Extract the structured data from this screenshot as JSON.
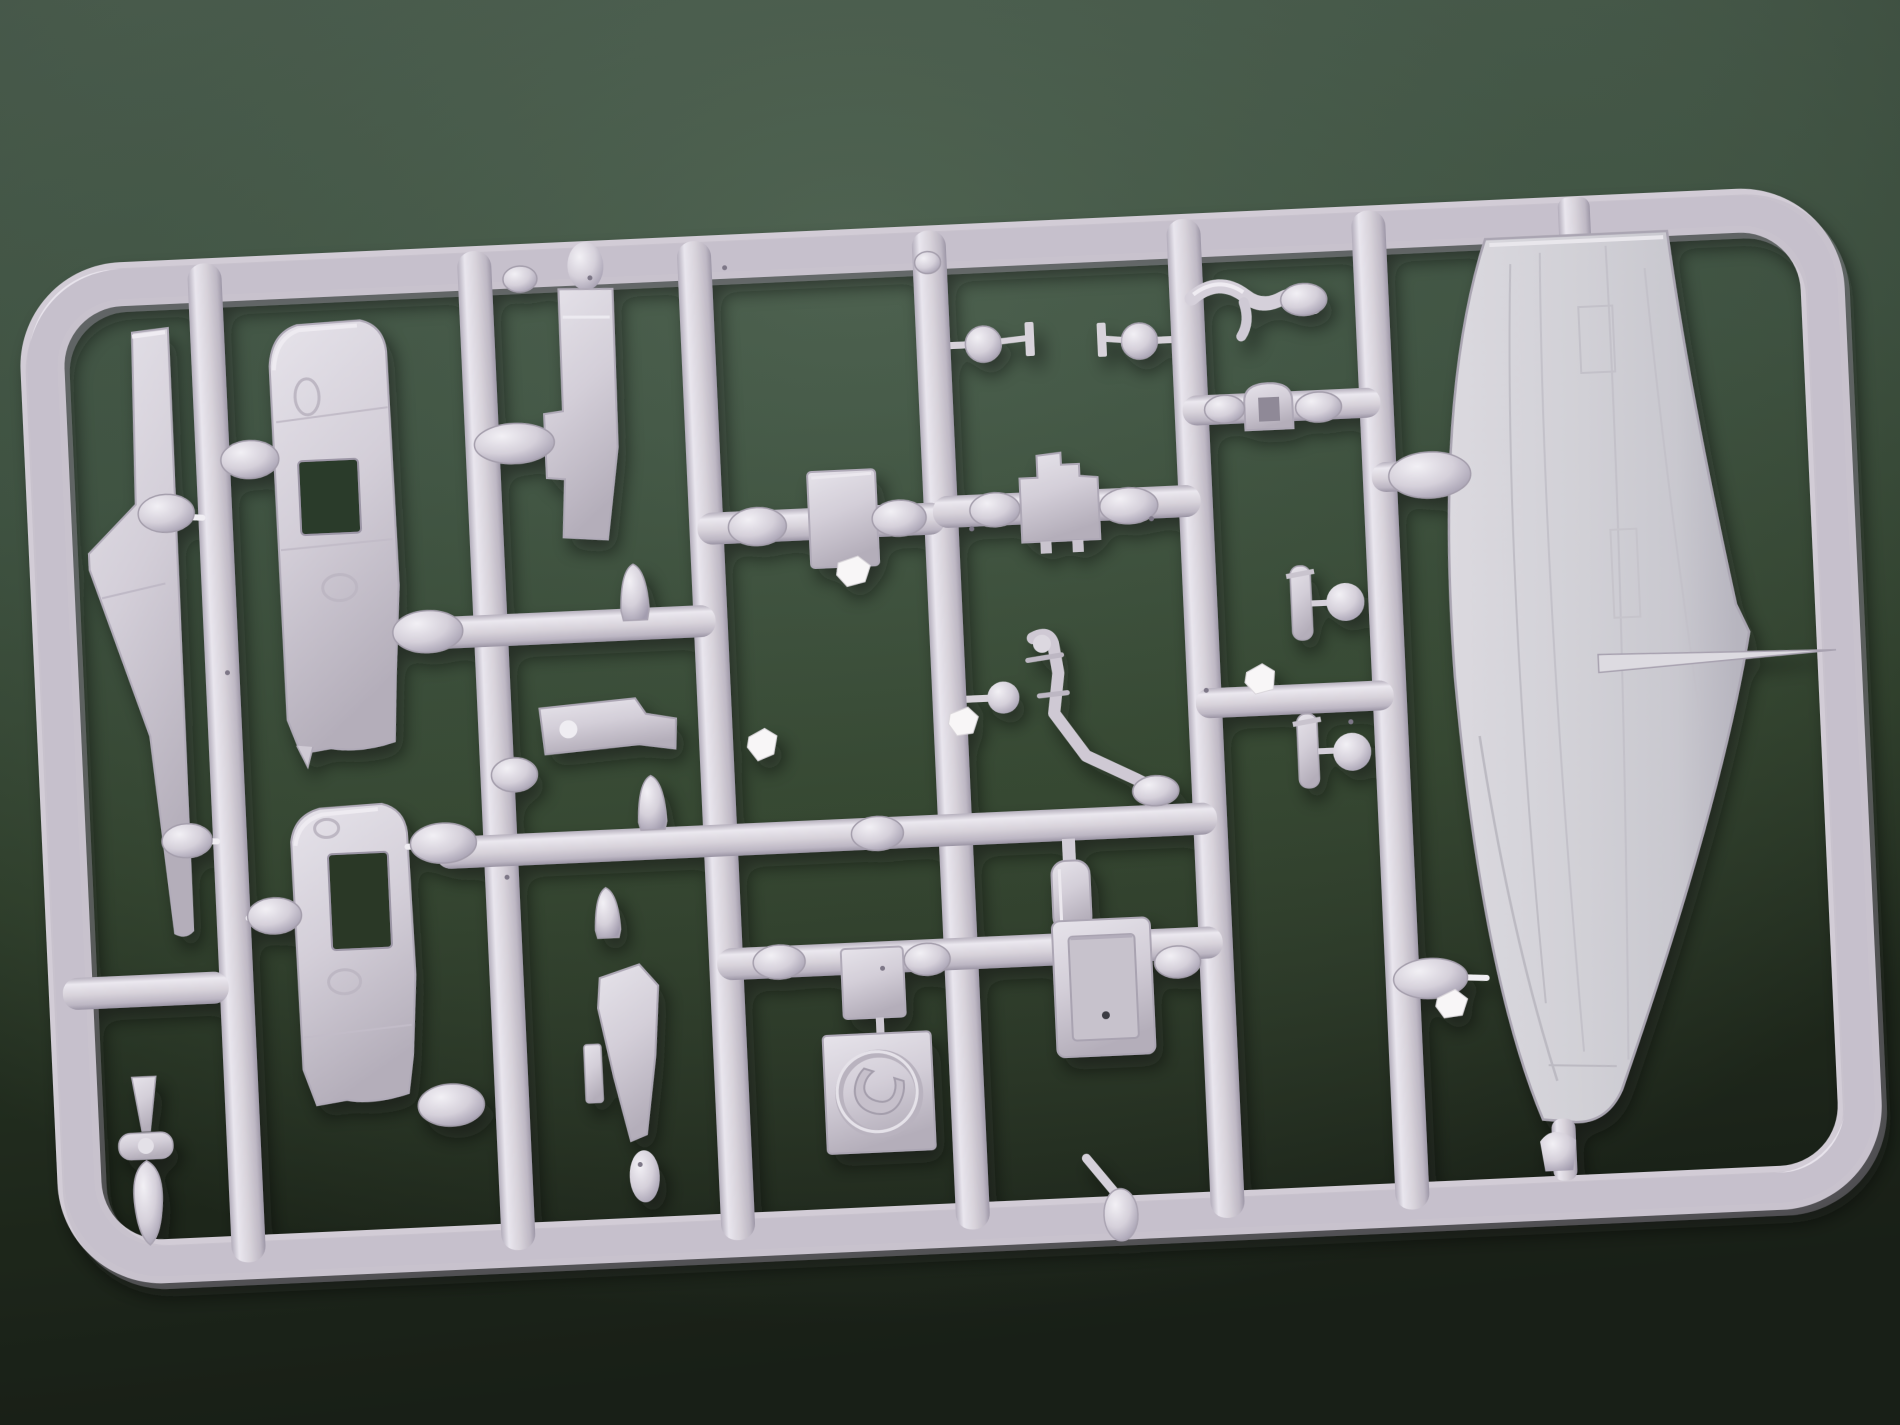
{
  "scene": {
    "type": "photograph",
    "subject": "injection-molded plastic model kit sprue (runner frame with unpainted aircraft parts) lying on a dark green surface",
    "background_color_top": "#4a5c49",
    "background_color_mid": "#3a4f38",
    "background_color_dark": "#222c20",
    "plastic_color": "#d6d1d8",
    "plastic_highlight": "#eeebf1",
    "plastic_shadow": "#a29caa",
    "flash_color": "#f8f6f7"
  },
  "sprue": {
    "marking_letter": "C",
    "frame_shape": "rounded rectangle frame, slightly rotated counter-clockwise",
    "vertical_runner_count": 6,
    "parts": [
      {
        "name": "tail-fin",
        "label": "swept tail fin blade"
      },
      {
        "name": "fuselage-half-upper",
        "label": "fuselage half with window cutout"
      },
      {
        "name": "fuselage-half-lower",
        "label": "fuselage half with window cutout"
      },
      {
        "name": "canopy-side-panel",
        "label": "tall side panel with tab"
      },
      {
        "name": "seat-bracket",
        "label": "seat / mount bracket"
      },
      {
        "name": "square-panel",
        "label": "flat square panel"
      },
      {
        "name": "bulkhead-panel",
        "label": "stepped bulkhead panel"
      },
      {
        "name": "engine-cowl",
        "label": "cowl with square opening"
      },
      {
        "name": "curved-bracket",
        "label": "curved exhaust bracket"
      },
      {
        "name": "ball-fitting-left",
        "label": "ball fitting with tab"
      },
      {
        "name": "ball-fitting-right",
        "label": "ball fitting with tab"
      },
      {
        "name": "gun-figure",
        "label": "small gun / figure casting"
      },
      {
        "name": "fuel-bottle",
        "label": "bottle-shaped tank"
      },
      {
        "name": "propeller-blade",
        "label": "propeller blade with tab"
      },
      {
        "name": "spinner-assembly",
        "label": "spinner cone, hub disc and teardrop body"
      },
      {
        "name": "small-square-panel",
        "label": "small flat square panel"
      },
      {
        "name": "hatch-frame",
        "label": "open rectangular hatch frame with pin hole"
      },
      {
        "name": "marking-plate",
        "label": "square plate with embossed circle and letter"
      },
      {
        "name": "bomb-upper",
        "label": "small finned bomb"
      },
      {
        "name": "bomb-lower",
        "label": "small finned bomb"
      },
      {
        "name": "cane-lever",
        "label": "lever with oval body"
      },
      {
        "name": "wing-panel",
        "label": "large one-piece lower wing with panel lines and pitot spike"
      },
      {
        "name": "bullet-fairing-1",
        "label": "bullet fairing"
      },
      {
        "name": "bullet-fairing-2",
        "label": "bullet fairing"
      },
      {
        "name": "bullet-fairing-3",
        "label": "bullet fairing"
      },
      {
        "name": "sprue-gate-beads",
        "label": "oval molding gates joining parts to runners"
      },
      {
        "name": "flash-scraps",
        "label": "small torn white plastic nubs"
      }
    ]
  }
}
